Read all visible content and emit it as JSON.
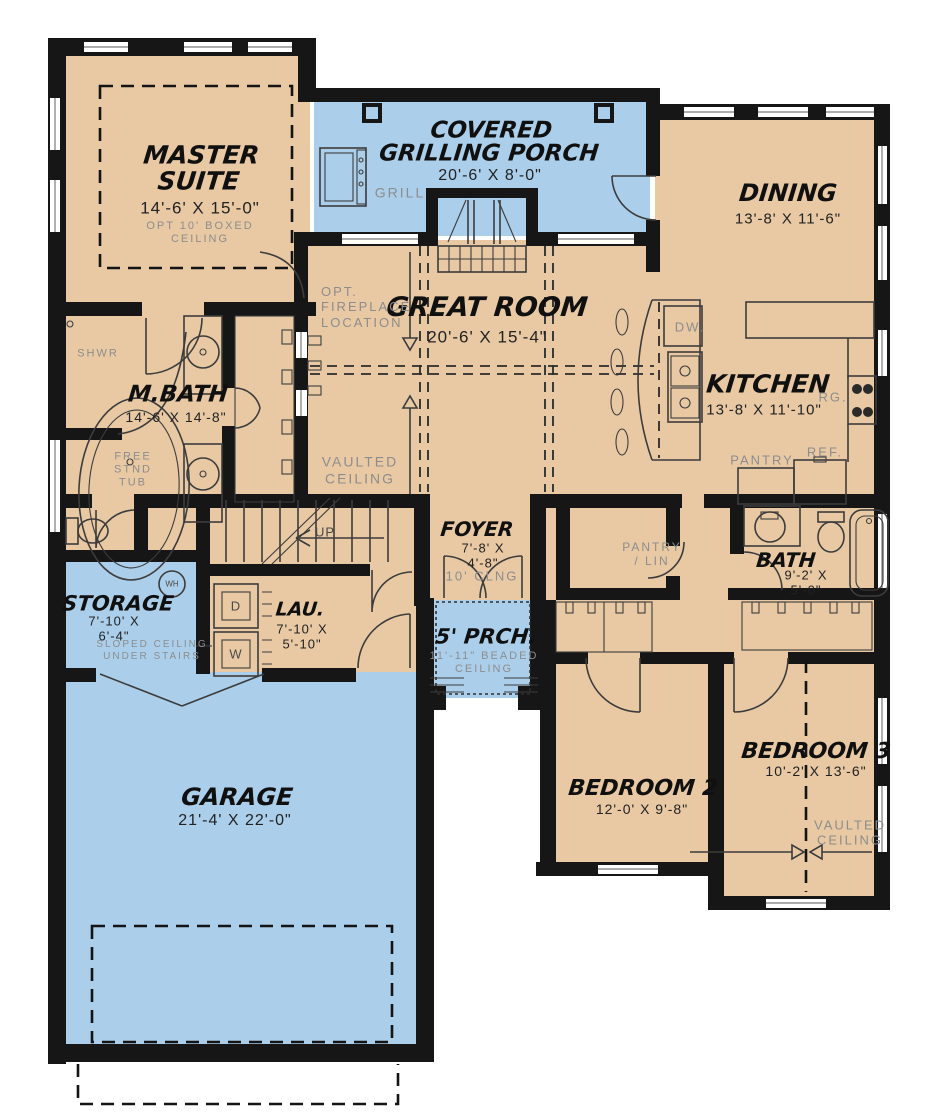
{
  "colors": {
    "floor_tan": "#e8c9a4",
    "porch_blue": "#abcfeb",
    "wall_black": "#161616",
    "label_gray": "#8d8d8d",
    "dim_text": "#222222"
  },
  "rooms": {
    "master_suite": {
      "name": "MASTER SUITE",
      "dims": "14'-6' X 15'-0\"",
      "note": "OPT 10' BOXED CEILING"
    },
    "grilling_porch": {
      "name": "COVERED GRILLING PORCH",
      "dims": "20'-6' X 8'-0\""
    },
    "dining": {
      "name": "DINING",
      "dims": "13'-8' X 11'-6\""
    },
    "great_room": {
      "name": "GREAT ROOM",
      "dims": "20'-6' X 15'-4\"",
      "note_fireplace": "OPT. FIREPLACE LOCATION",
      "note_ceiling": "VAULTED CEILING"
    },
    "kitchen": {
      "name": "KITCHEN",
      "dims": "13'-8' X 11'-10\""
    },
    "master_bath": {
      "name": "M.BATH",
      "dims": "14'-6' X 14'-8\"",
      "shower": "SHWR",
      "tub": "FREE STND TUB"
    },
    "foyer": {
      "name": "FOYER",
      "dims": "7'-8' X 4'-8\"",
      "note": "10' CLNG"
    },
    "pantry_lin": {
      "name": "PANTRY / LIN"
    },
    "bath": {
      "name": "BATH",
      "dims": "9'-2' X 5'-0\""
    },
    "storage": {
      "name": "STORAGE",
      "dims": "7'-10' X 6'-4\"",
      "note": "SLOPED CEILING UNDER STAIRS"
    },
    "laundry": {
      "name": "LAU.",
      "dims": "7'-10' X 5'-10\""
    },
    "front_porch": {
      "name": "5' PRCH.",
      "note": "11'-11\" BEADED CEILING"
    },
    "garage": {
      "name": "GARAGE",
      "dims": "21'-4' X 22'-0\""
    },
    "bedroom2": {
      "name": "BEDROOM 2",
      "dims": "12'-0' X 9'-8\""
    },
    "bedroom3": {
      "name": "BEDROOM 3",
      "dims": "10'-2' X 13'-6\"",
      "note_ceiling": "VAULTED CEILING"
    }
  },
  "fixtures": {
    "grill": "GRILL",
    "dishwasher": "DW.",
    "range": "RG.",
    "refrigerator": "REF.",
    "pantry": "PANTRY",
    "stairs_up": "UP",
    "water_heater": "WH",
    "dryer": "D",
    "washer": "W"
  }
}
